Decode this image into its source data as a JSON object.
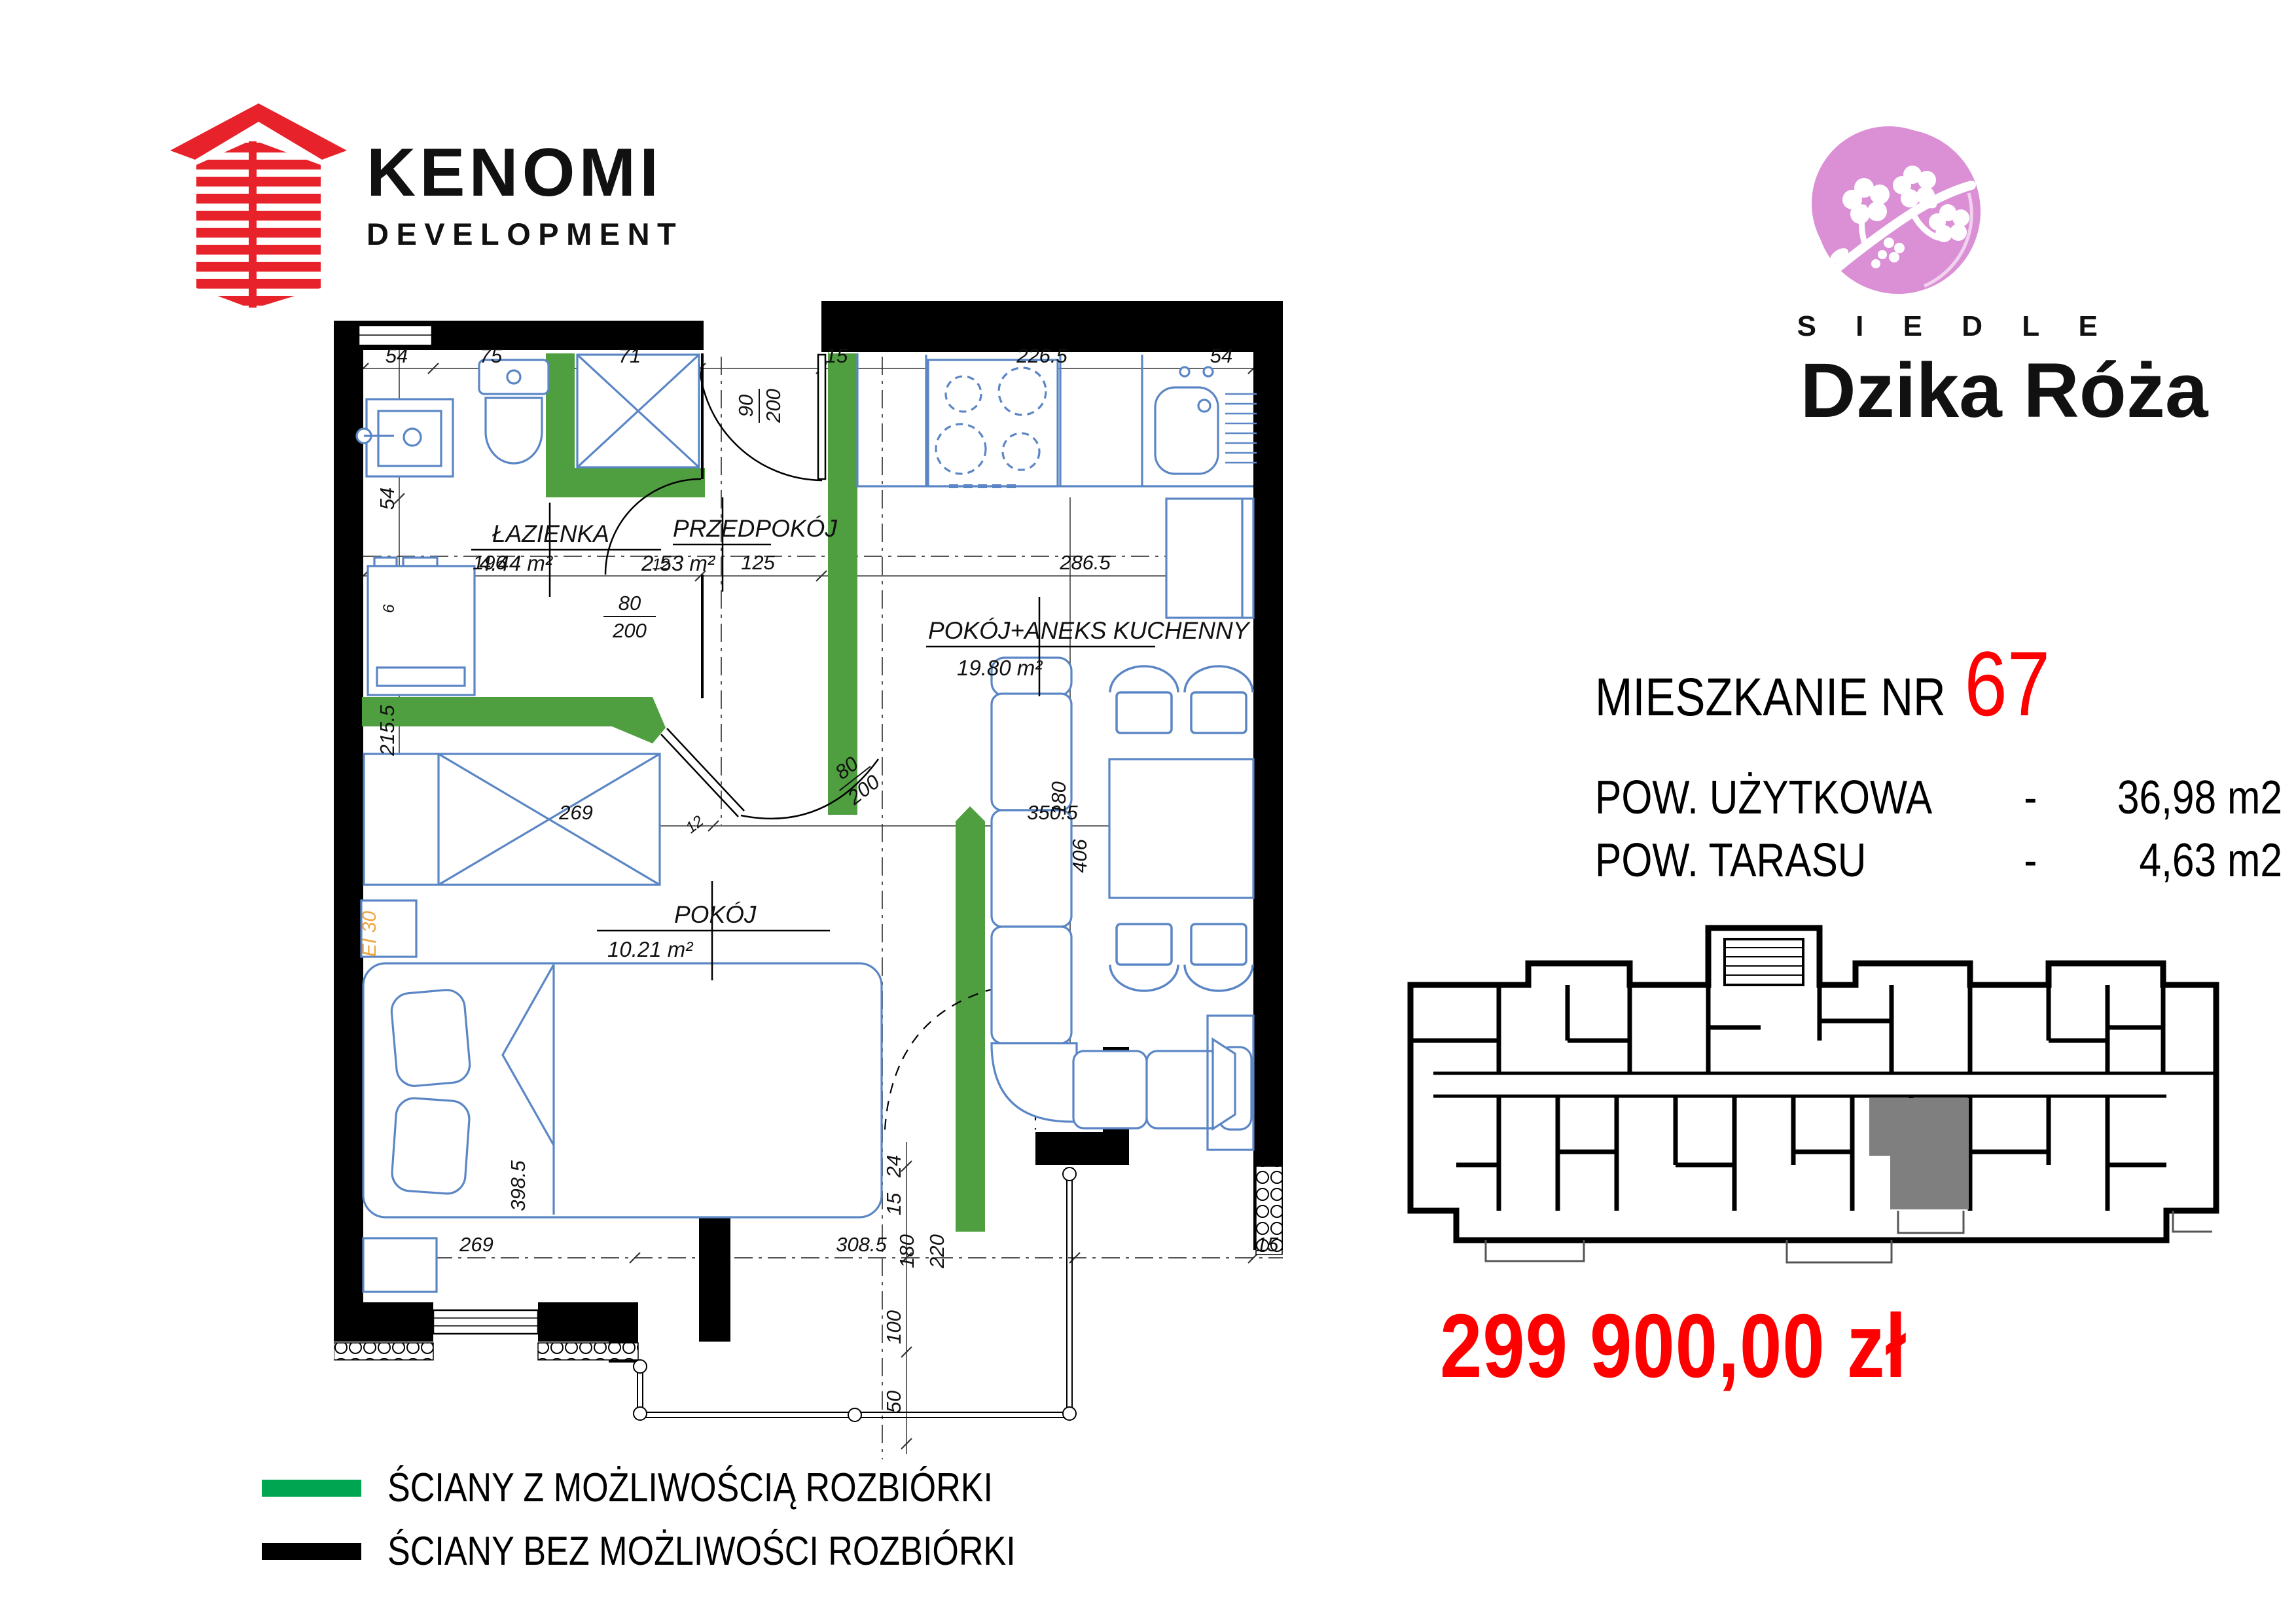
{
  "branding": {
    "developer": "KENOMI",
    "developer_sub": "DEVELOPMENT",
    "estate_label": "O S I E D L E",
    "estate_name": "Dzika Róża"
  },
  "unit": {
    "title_label": "MIESZKANIE NR",
    "number": "67",
    "rows": [
      {
        "label": "POW. UŻYTKOWA",
        "dash": "-",
        "value": "36,98 m2"
      },
      {
        "label": "POW. TARASU",
        "dash": "-",
        "value": "4,63 m2"
      }
    ],
    "price": "299 900,00 zł"
  },
  "legend": {
    "removable": "ŚCIANY Z MOŻLIWOŚCIĄ ROZBIÓRKI",
    "fixed": "ŚCIANY BEZ MOŻLIWOŚCI ROZBIÓRKI"
  },
  "plan": {
    "rooms": {
      "bathroom": {
        "name": "ŁAZIENKA",
        "area": "4.44 m²"
      },
      "hall": {
        "name": "PRZEDPOKÓJ",
        "area": "2.53 m²"
      },
      "living": {
        "name": "POKÓJ+ANEKS KUCHENNY",
        "area": "19.80 m²"
      },
      "bedroom": {
        "name": "POKÓJ",
        "area": "10.21 m²"
      }
    },
    "doors": {
      "entrance": {
        "w": "90",
        "h": "200"
      },
      "bathroom": {
        "w": "80",
        "h": "200"
      },
      "bedroom": {
        "w": "80",
        "h": "200"
      }
    },
    "dims": {
      "top": [
        "54",
        "75",
        "71",
        "15",
        "226.5",
        "54"
      ],
      "left": [
        "54",
        "6",
        "215.5"
      ],
      "mid": [
        "196",
        "125",
        "286.5"
      ],
      "mid_small": "12",
      "row": [
        "269",
        "350.5"
      ],
      "door_small": "12",
      "kitchen_depth": "180",
      "living_height": "406",
      "bed": "398.5",
      "bottom": [
        "269",
        "308.5",
        "15"
      ],
      "bottom_vertical": [
        "24",
        "15",
        "180",
        "220",
        "100",
        "50"
      ]
    },
    "fire_rating": "EI 30",
    "colors": {
      "removable_wall": "#4f9e3f",
      "legend_green": "#00a551",
      "wall": "#000000",
      "furniture": "#5b86c5",
      "highlight": "#7f7f7f",
      "accent_red": "#fe0000",
      "logo_red": "#e8222a",
      "logo_pink": "#db90d6",
      "fire_orange": "#f0a43e"
    }
  }
}
